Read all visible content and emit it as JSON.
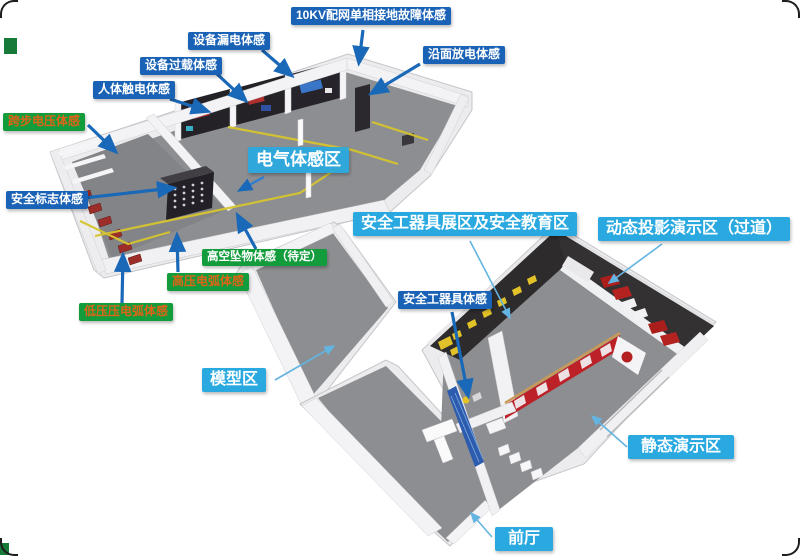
{
  "labels": {
    "ten_kv": {
      "text": "10KV配网单相接地故障体感"
    },
    "yanmian": {
      "text": "沿面放电体感"
    },
    "loudian": {
      "text": "设备漏电体感"
    },
    "guozai": {
      "text": "设备过载体感"
    },
    "chudian": {
      "text": "人体触电体感"
    },
    "kuabu": {
      "text": "跨步电压体感"
    },
    "biaozhi": {
      "text": "安全标志体感"
    },
    "dianqi": {
      "text": "电气体感区"
    },
    "gaokong": {
      "text": "高空坠物体感（待定）"
    },
    "gaoya": {
      "text": "高压电弧体感"
    },
    "diya": {
      "text": "低压压电弧体感"
    },
    "zhanqu": {
      "text": "安全工器具展区及安全教育区"
    },
    "dongtai": {
      "text": "动态投影演示区（过道）"
    },
    "gongqiju": {
      "text": "安全工器具体感"
    },
    "moxing": {
      "text": "模型区"
    },
    "jingtai": {
      "text": "静态演示区"
    },
    "qianting": {
      "text": "前厅"
    }
  },
  "colors": {
    "label_blue_bg": "#1a62b5",
    "label_green_bg": "#139c3b",
    "label_cyan_bg": "#29a9e0",
    "green_label_orange_text": "#dd6418",
    "label_white_text": "#ffffff",
    "arrow_blue": "#1a68b8",
    "arrow_cyan": "#62b4e2",
    "floor_gray": "#8d8e91",
    "wall_white": "#f0f0f2",
    "dark_wall": "#2e2b2d",
    "accent_red": "#bc2127",
    "accent_yellow": "#e2c229",
    "accent_blue_counter": "#2d5cae"
  }
}
